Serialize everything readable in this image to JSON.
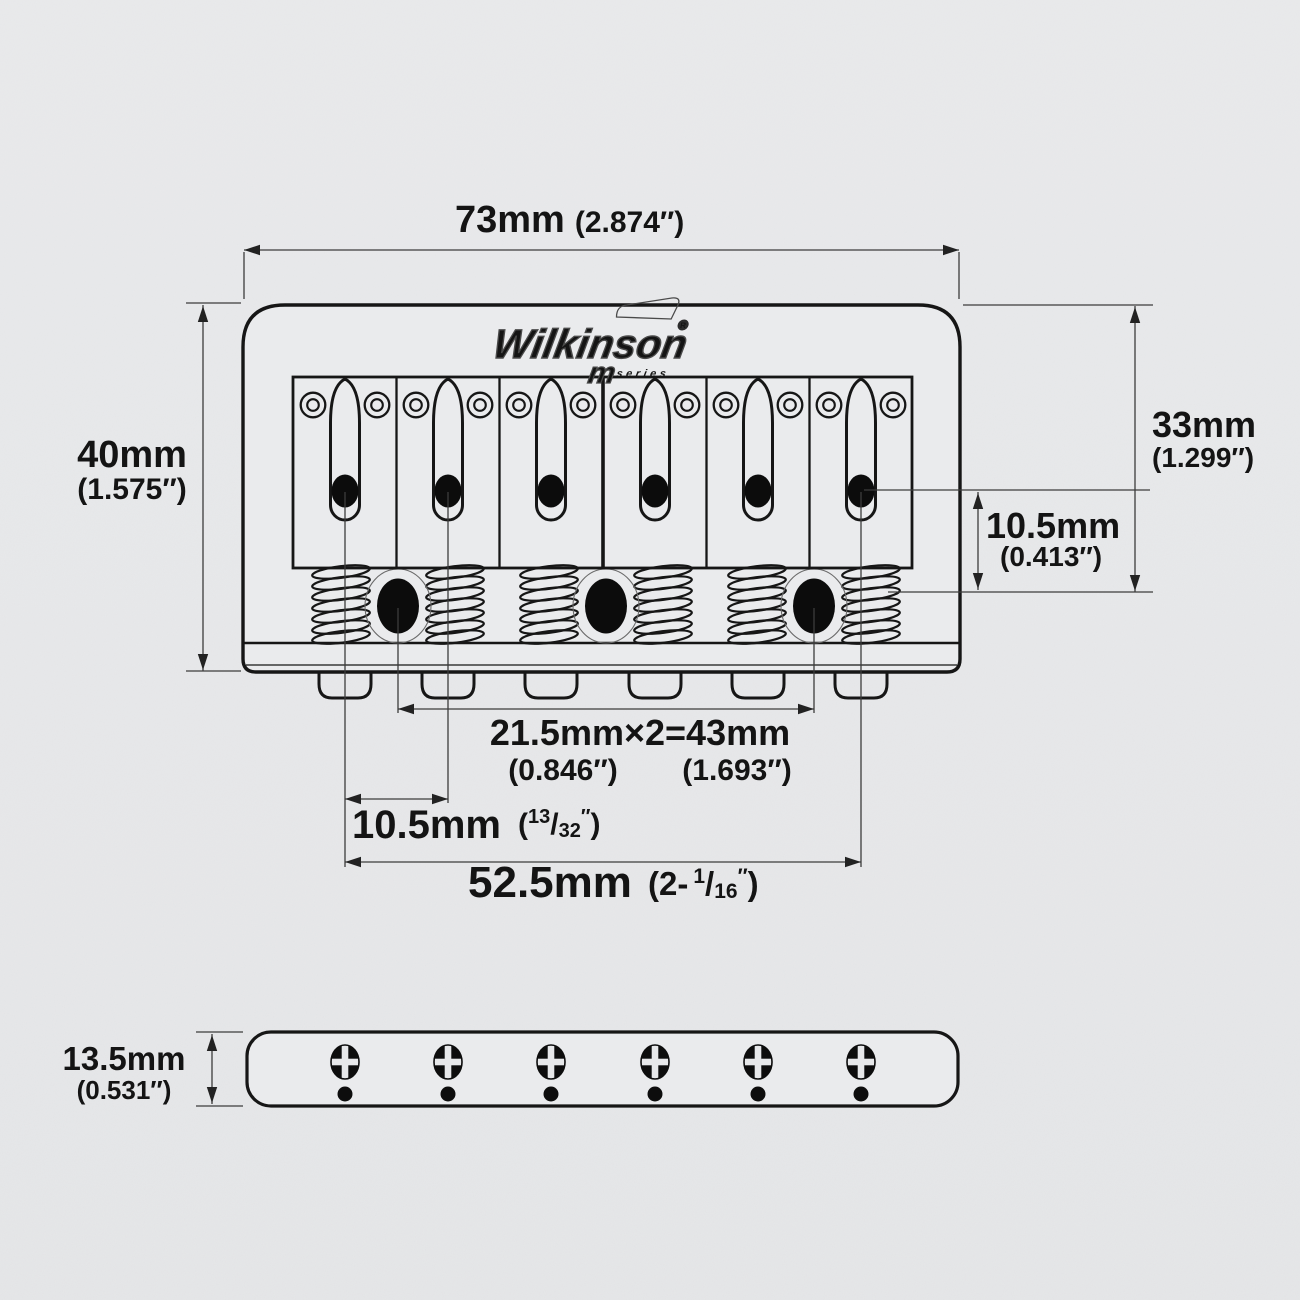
{
  "colors": {
    "background": "#e8e9eb",
    "line_ink": "#161616",
    "dim_line": "#3c3c3c",
    "text": "#141414"
  },
  "logo": {
    "brand": "Wilkinson",
    "reg": "R",
    "m_label": "m",
    "series_label": "series"
  },
  "dims": {
    "overall_width": {
      "mm": "73mm",
      "inch": "(2.874″)"
    },
    "overall_depth": {
      "mm": "40mm",
      "inch": "(1.575″)"
    },
    "body_depth": {
      "mm": "33mm",
      "inch": "(1.299″)"
    },
    "hole_to_screw": {
      "mm": "10.5mm",
      "inch": "(0.413″)"
    },
    "mount_screw_spacing": {
      "mm": "21.5mm×2=43mm",
      "inch_half": "(0.846″)",
      "inch_full": "(1.693″)"
    },
    "string_pitch": {
      "mm": "10.5mm",
      "paren_open": "(",
      "frac_num": "13",
      "frac_slash": "/",
      "frac_den": "32",
      "prime": "″",
      "paren_close": ")"
    },
    "string_span": {
      "mm": "52.5mm",
      "paren_open": "(2-",
      "frac_num": "1",
      "frac_slash": "/",
      "frac_den": "16",
      "prime": "″",
      "paren_close": ")"
    },
    "plate_thickness": {
      "mm": "13.5mm",
      "inch": "(0.531″)"
    }
  }
}
